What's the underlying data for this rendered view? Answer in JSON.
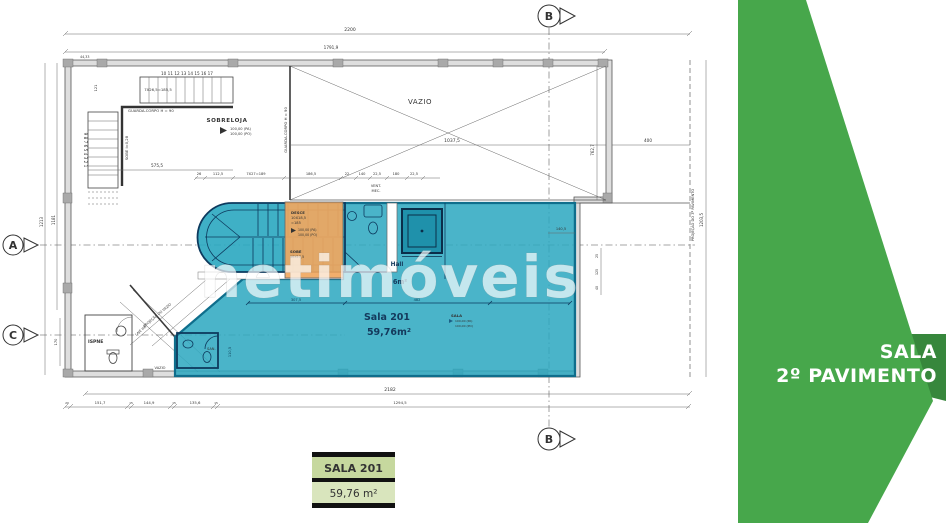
{
  "colors": {
    "teal": "#2aa7c0",
    "teal_dark": "#0f6e8c",
    "orange": "#f0a75f",
    "green": "#47a74b",
    "green_dark": "#37873c",
    "navy": "#14395c",
    "label_box_green": "#c6d89e"
  },
  "watermark": "netimóveis",
  "side_panel": {
    "line1": "SALA",
    "line2": "2º PAVIMENTO"
  },
  "area_label_box": {
    "title": "SALA 201",
    "area": "59,76 m²"
  },
  "plan": {
    "markers": {
      "a": "A",
      "b": "B",
      "c": "C"
    },
    "rooms": {
      "vazio": "VAZIO",
      "sobreloja": "SOBRELOJA",
      "hall": "Hall",
      "hall_area": "6m²",
      "sala201": "Sala 201",
      "sala201_area": "59,76m²",
      "sala_small": "SALA",
      "ispne": "ISPNE",
      "san": "SAN.",
      "vazio_small": "VAZIO",
      "vent_line1": "VENT.",
      "vent_line2": "MEC."
    },
    "levels": {
      "pa": "100,00 (PA)",
      "po": "100,00 (PO)"
    },
    "stair": {
      "steps_top": "10 11 12 13 14 15 16 17",
      "steps_side": "9 8 7 6 5 4 3 2 1",
      "run_note": "7X26,5=185,5",
      "sobe_note": "SOBE i=0,28",
      "guarda_corpo": "GUARDA-CORPO H = 90",
      "desce_line1": "DESCE",
      "desce_line2": "10X18,5",
      "desce_line3": "=185",
      "sobe_line1": "SOBE",
      "sobe_line2": "10X17,5"
    },
    "annotations": {
      "guarda_corpo_vazio": "GUARDA-CORPO H = 90",
      "proj_vazio": "PROJEÇÃO DO VAZIO",
      "laje_imp": "LAJE IMP.",
      "proj_pav": "PROJEÇÃO DO 3º PAVIMENTO"
    },
    "dims": {
      "top_total": "2200",
      "top_inner": "1791,9",
      "top_corner": "44,33",
      "vazio_width": "1037,5",
      "right_400": "400",
      "right_762": "762,7",
      "right_1203": "1203,5",
      "left_1213": "1213",
      "left_1181": "1181",
      "left_121": "121",
      "left_170": "170",
      "stair_575": "575,5",
      "mid_26": "26",
      "mid_112": "112,5",
      "mid_7x27": "7X27=189",
      "mid_186": "186,5",
      "mid_22": "22",
      "mid_140": "140",
      "mid_225a": "22,5",
      "mid_180": "180",
      "mid_225b": "22,5",
      "in_307": "307,5",
      "in_482": "482",
      "in_110": "110,5",
      "r_140_5": "140,5",
      "r_25": "25",
      "r_125": "125",
      "r_40": "40",
      "bot_2182": "2182",
      "bot_1294": "1294,5",
      "bot_20": "20",
      "bot_151": "151,7",
      "bot_15a": "15",
      "bot_144": "144,9",
      "bot_15b": "15",
      "bot_135": "135,6",
      "bot_15c": "15"
    }
  }
}
